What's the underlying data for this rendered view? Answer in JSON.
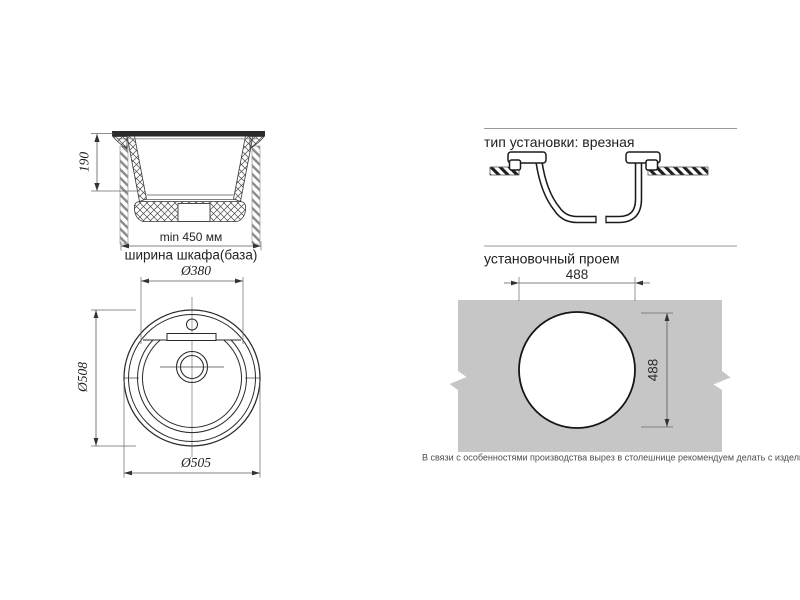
{
  "colors": {
    "background": "#ffffff",
    "drawing_line": "#2a2a2a",
    "dimension_line": "#5a5a5a",
    "countertop_gray": "#c6c6c6",
    "divider_rule": "#9a9a9a",
    "heading_text": "#1d1d1d",
    "note_text": "#4d4d4d"
  },
  "side_view": {
    "depth_label": "190",
    "cabinet_min_label": "min 450 мм",
    "cabinet_base_label": "ширина шкафа(база)"
  },
  "top_view": {
    "bowl_diameter_label": "Ø380",
    "outer_diameter_side_label": "Ø508",
    "outer_diameter_bottom_label": "Ø505"
  },
  "installation": {
    "heading": "тип установки: врезная"
  },
  "cutout": {
    "heading": "установочный проем",
    "width_label": "488",
    "height_label": "488"
  },
  "note": {
    "text": "В связи с особенностями производства вырез в столешнице рекомендуем делать с изделия."
  }
}
